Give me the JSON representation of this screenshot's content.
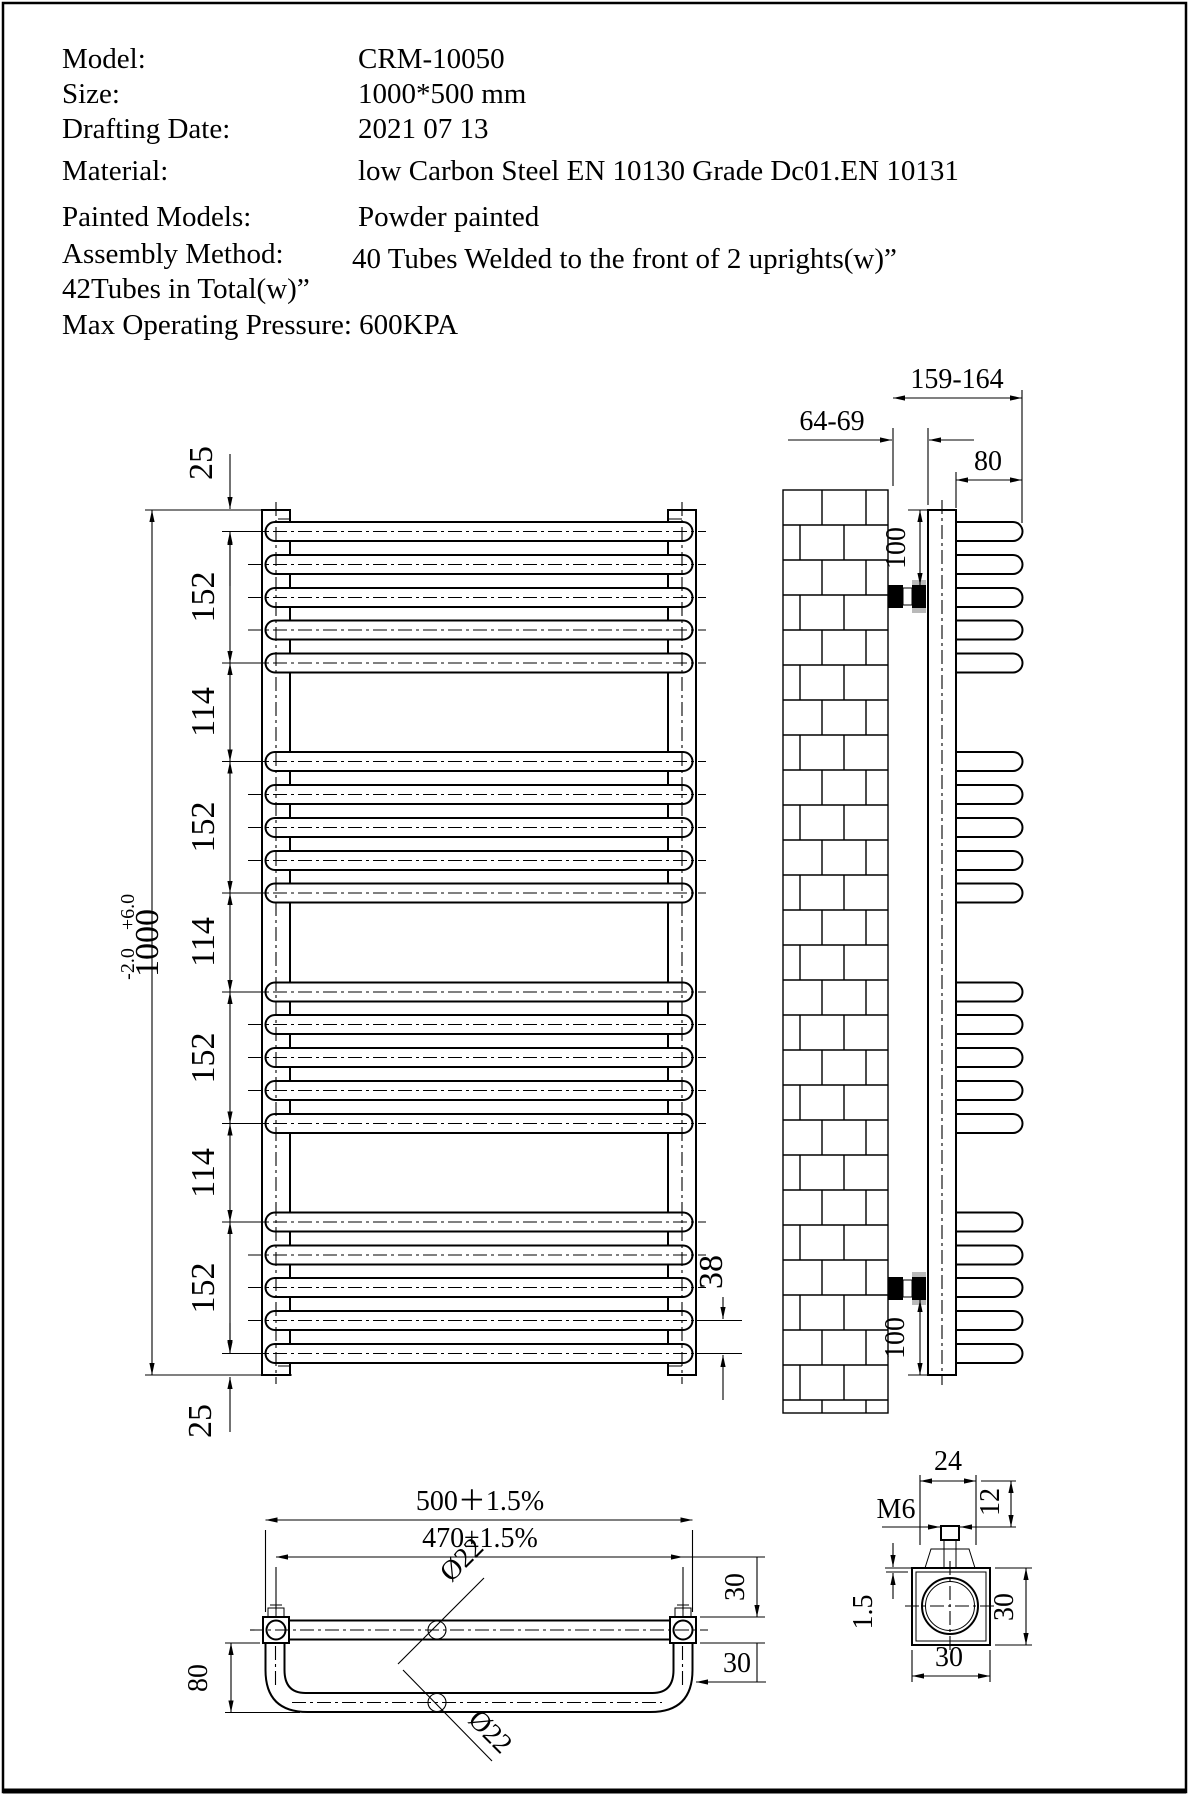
{
  "page": {
    "bg": "#ffffff",
    "line_color": "#000000"
  },
  "header": {
    "rows": [
      {
        "label": "Model:",
        "value": "CRM-10050"
      },
      {
        "label": "Size:",
        "value": "1000*500 mm"
      },
      {
        "label": "Drafting Date:",
        "value": "2021 07 13"
      },
      {
        "label": "Material:",
        "value": "low Carbon Steel  EN 10130 Grade Dc01.EN 10131"
      },
      {
        "label": "Painted Models:",
        "value": "Powder painted"
      },
      {
        "label": "Assembly Method:",
        "value": "40 Tubes Welded to the front of 2 uprights(w)”"
      }
    ],
    "line7": "42Tubes in Total(w)”",
    "line8": "Max Operating Pressure: 600KPA"
  },
  "front_view": {
    "chain": [
      "25",
      "152",
      "114",
      "152",
      "114",
      "152",
      "114",
      "152",
      "25"
    ],
    "overall": {
      "value": "1000",
      "tol_plus": "+6.0",
      "tol_minus": "-2.0"
    },
    "tube_pitch_label": "38",
    "rows_y": [
      531.5,
      564.5,
      597.5,
      630,
      663,
      761.5,
      794.5,
      827.5,
      860.5,
      893,
      992,
      1024.5,
      1057.5,
      1090.5,
      1123.5,
      1222,
      1255,
      1287.5,
      1320.5,
      1353.5
    ],
    "ext_rows_y": [
      531.5,
      663,
      761.5,
      893,
      992,
      1123.5,
      1222,
      1353.5
    ]
  },
  "side_view": {
    "labels": {
      "wall_to_upright": "64-69",
      "overall_depth": "159-164",
      "tube_length": "80",
      "top_bracket": "100",
      "bottom_bracket": "100"
    }
  },
  "bottom_view": {
    "labels": {
      "overall_width": "500＋1.5%",
      "upright_centers": "470±1.5%",
      "tube_dia_top": "Ø22",
      "tube_dia_loop": "Ø22",
      "loop_depth": "80",
      "edge_top": "30",
      "edge_side": "30"
    }
  },
  "detail_view": {
    "labels": {
      "plate_width": "24",
      "stud_height": "12",
      "thread": "M6",
      "wall_thickness": "1.5",
      "width": "30",
      "height": "30"
    }
  }
}
